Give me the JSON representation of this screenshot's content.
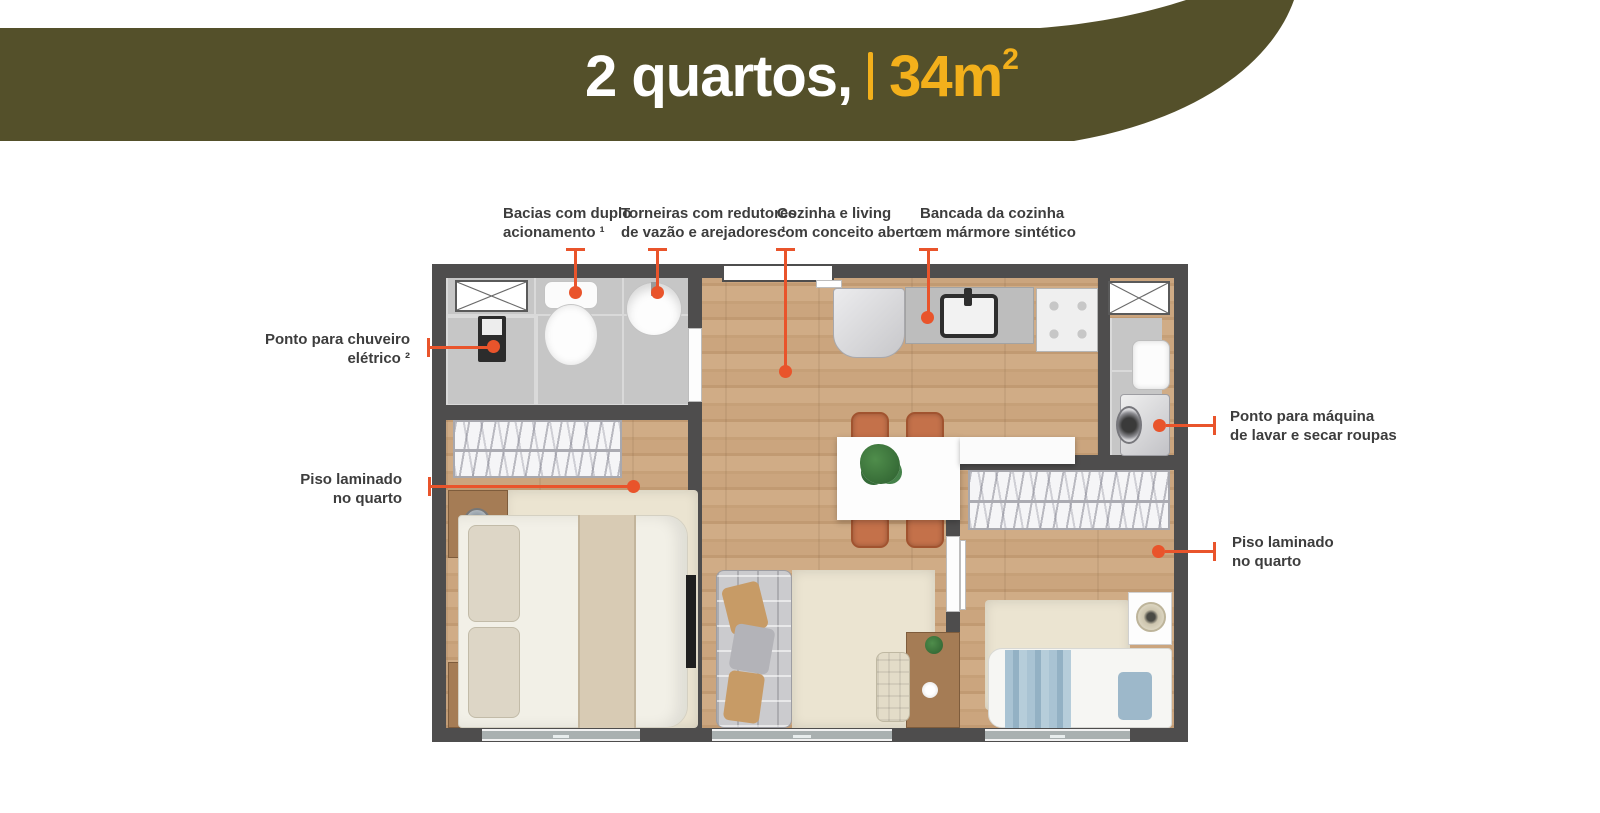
{
  "header": {
    "title": "2 quartos,",
    "area_value": "34m",
    "area_superscript": "2",
    "background_color": "#54502a",
    "accent_yellow": "#f3b01b"
  },
  "callouts": {
    "bacias": {
      "line1": "Bacias com duplo",
      "line2": "acionamento ¹"
    },
    "torneiras": {
      "line1": "Torneiras com redutores",
      "line2": "de vazão e arejadores ¹"
    },
    "cozinha": {
      "line1": "Cozinha e living",
      "line2": "com conceito aberto"
    },
    "bancada": {
      "line1": "Bancada da cozinha",
      "line2": "em mármore sintético"
    },
    "chuveiro": {
      "line1": "Ponto para chuveiro",
      "line2": "elétrico ²"
    },
    "piso_esquerda": {
      "line1": "Piso laminado",
      "line2": "no quarto"
    },
    "maquina": {
      "line1": "Ponto para máquina",
      "line2": "de lavar e secar roupas"
    },
    "piso_direita": {
      "line1": "Piso laminado",
      "line2": "no quarto"
    }
  },
  "colors": {
    "callout_accent": "#e9542b",
    "label_text": "#3d3d3d",
    "wall": "#4e4d4d",
    "wood_floor": "#c9a47c",
    "tile_floor": "#c6c6c6",
    "rug": "#ebe4d1"
  }
}
